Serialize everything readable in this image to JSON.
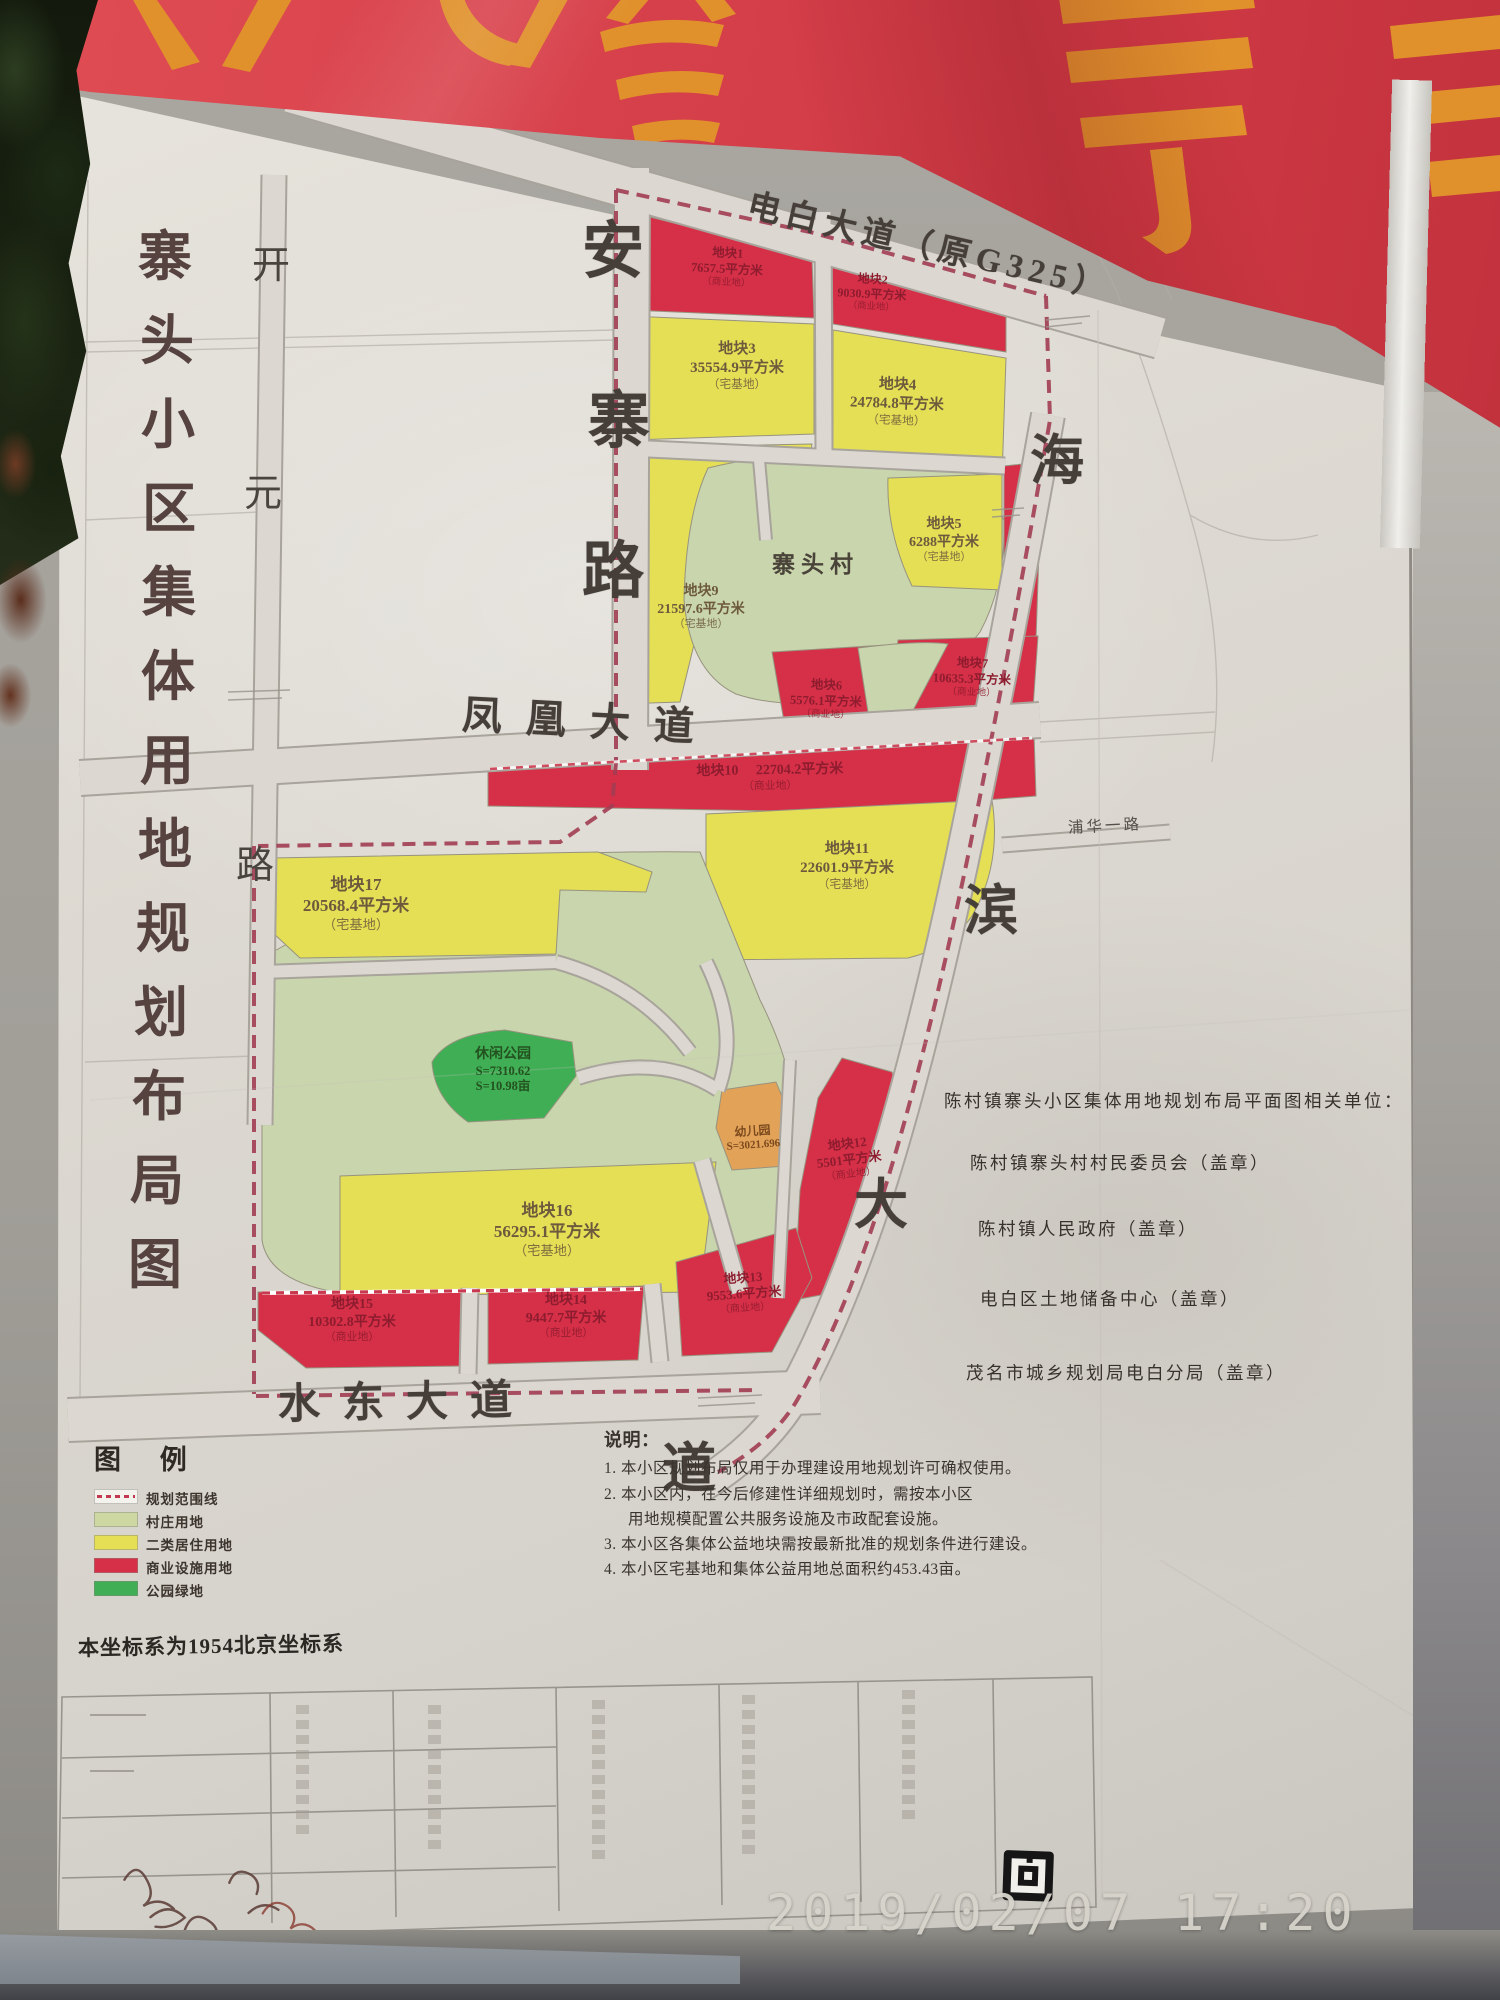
{
  "photo": {
    "timestamp": "2019/02/07 17:20"
  },
  "banner": {
    "background_color": "#d8454e",
    "glyph_color": "#e0912c"
  },
  "board": {
    "title": "寨头小区集体用地规划布局图",
    "title_chars": [
      "寨",
      "头",
      "小",
      "区",
      "集",
      "体",
      "用",
      "地",
      "规",
      "划",
      "布",
      "局",
      "图"
    ],
    "map": {
      "roads": {
        "dianbai": "电白大道（原G325）",
        "anzhai_chars": [
          "安",
          "寨",
          "路"
        ],
        "kaiyuan_chars": [
          "开",
          "元",
          "路"
        ],
        "fenghuang": "凤凰大道",
        "shuidong": "水东大道",
        "haibin_chars": [
          "海",
          "滨",
          "大",
          "道"
        ],
        "puhua": "浦华一路"
      },
      "village_label": "寨头村",
      "park": {
        "name": "休闲公园",
        "area1": "S=7310.62",
        "area2": "S=10.98亩"
      },
      "kindergarten": {
        "name": "幼儿园",
        "area": "S=3021.696"
      },
      "parcels": {
        "p1": {
          "name": "地块1",
          "area": "7657.5平方米",
          "note": "（商业地）"
        },
        "p2": {
          "name": "地块2",
          "area": "9030.9平方米",
          "note": "（商业地）"
        },
        "p3": {
          "name": "地块3",
          "area": "35554.9平方米",
          "note": "（宅基地）"
        },
        "p4": {
          "name": "地块4",
          "area": "24784.8平方米",
          "note": "（宅基地）"
        },
        "p5": {
          "name": "地块5",
          "area": "6288平方米",
          "note": "（宅基地）"
        },
        "p6": {
          "name": "地块6",
          "area": "5576.1平方米",
          "note": "（商业地）"
        },
        "p7": {
          "name": "地块7",
          "area": "10635.3平方米",
          "note": "（商业地）"
        },
        "p9": {
          "name": "地块9",
          "area": "21597.6平方米",
          "note": "（宅基地）"
        },
        "p10": {
          "name": "地块10",
          "area": "22704.2平方米",
          "note": "（商业地）"
        },
        "p11": {
          "name": "地块11",
          "area": "22601.9平方米",
          "note": "（宅基地）"
        },
        "p12": {
          "name": "地块12",
          "area": "5501平方米",
          "note": "（商业地）"
        },
        "p13": {
          "name": "地块13",
          "area": "9553.6平方米",
          "note": "（商业地）"
        },
        "p14": {
          "name": "地块14",
          "area": "9447.7平方米",
          "note": "（商业地）"
        },
        "p15": {
          "name": "地块15",
          "area": "10302.8平方米",
          "note": "（商业地）"
        },
        "p16": {
          "name": "地块16",
          "area": "56295.1平方米",
          "note": "（宅基地）"
        },
        "p17": {
          "name": "地块17",
          "area": "20568.4平方米",
          "note": "（宅基地）"
        }
      }
    },
    "legend": {
      "title": "图 例",
      "items": [
        {
          "label": "规划范围线",
          "type": "boundary"
        },
        {
          "label": "村庄用地",
          "color": "#ccd7a2"
        },
        {
          "label": "二类居住用地",
          "color": "#e4df55"
        },
        {
          "label": "商业设施用地",
          "color": "#d62f48"
        },
        {
          "label": "公园绿地",
          "color": "#3fae54"
        }
      ]
    },
    "coordinate_note": "本坐标系为1954北京坐标系",
    "related_units": {
      "header": "陈村镇寨头小区集体用地规划布局平面图相关单位：",
      "items": [
        "陈村镇寨头村村民委员会（盖章）",
        "陈村镇人民政府（盖章）",
        "电白区土地储备中心（盖章）",
        "茂名市城乡规划局电白分局（盖章）"
      ]
    },
    "notes": {
      "title": "说明：",
      "lines": [
        "1. 本小区规划布局仅用于办理建设用地规划许可确权使用。",
        "2. 本小区内，在今后修建性详细规划时，需按本小区",
        "用地规模配置公共服务设施及市政配套设施。",
        "3. 本小区各集体公益地块需按最新批准的规划条件进行建设。",
        "4. 本小区宅基地和集体公益用地总面积约453.43亩。"
      ]
    }
  }
}
